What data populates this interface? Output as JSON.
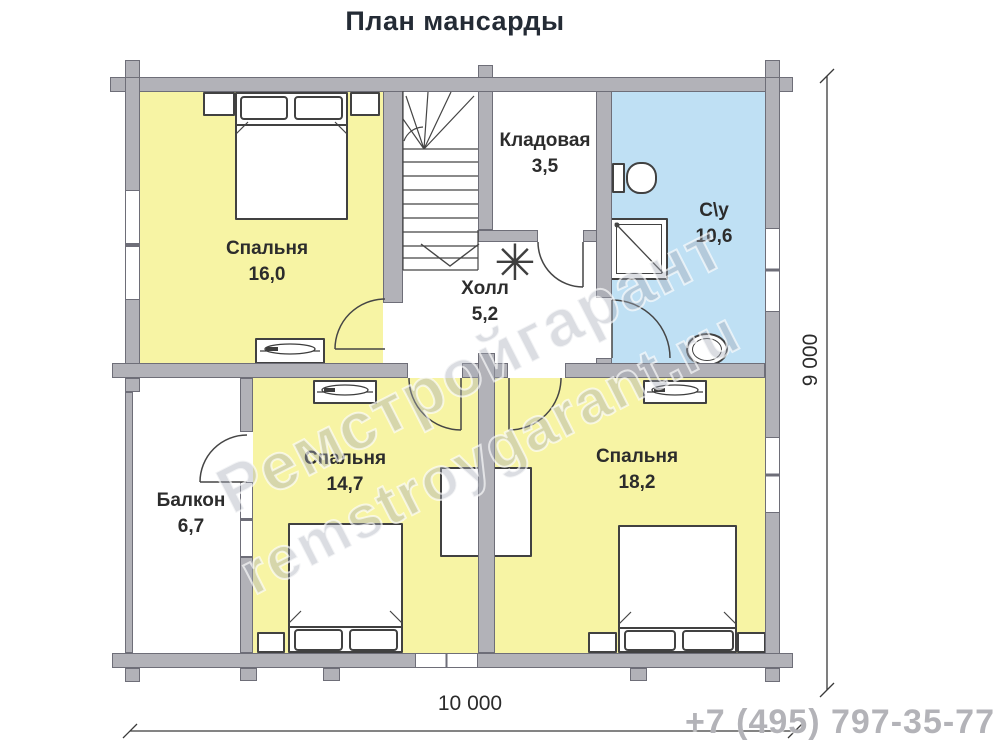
{
  "title": "План мансарды",
  "phone": "+7 (495) 797-35-77",
  "watermark": {
    "line1": "Ремстройгарант",
    "line2": "remstroygarant.ru"
  },
  "dimensions": {
    "width": "10 000",
    "height": "9 000"
  },
  "rooms": {
    "bedroom1": {
      "name": "Спальня",
      "area": "16,0"
    },
    "storage": {
      "name": "Кладовая",
      "area": "3,5"
    },
    "bathroom": {
      "name": "С\\у",
      "area": "10,6"
    },
    "hall": {
      "name": "Холл",
      "area": "5,2"
    },
    "balcony": {
      "name": "Балкон",
      "area": "6,7"
    },
    "bedroom2": {
      "name": "Спальня",
      "area": "14,7"
    },
    "bedroom3": {
      "name": "Спальня",
      "area": "18,2"
    }
  },
  "icons": {
    "plant_glyph": "✳"
  },
  "colors": {
    "bedroom_fill": "#f7f4a4",
    "bathroom_fill": "#bfe0f4",
    "wall": "#b2b2b8",
    "wall_border": "#6e6e78"
  }
}
